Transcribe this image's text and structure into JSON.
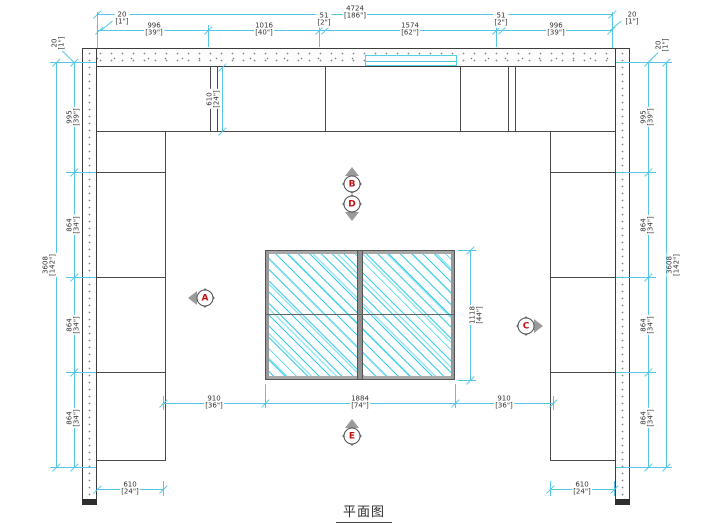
{
  "title": "平面图",
  "colors": {
    "dimension_line": "#55c7e5",
    "hatch": "#2dcde4",
    "drawing_line": "#4a4a4a",
    "marker_letter": "#c11111"
  },
  "dimensions": {
    "top_overall": {
      "mm": "4724",
      "inch": "[186\"]"
    },
    "top_chain": [
      {
        "mm": "20",
        "inch": "[1\"]"
      },
      {
        "mm": "996",
        "inch": "[39\"]"
      },
      {
        "mm": "1016",
        "inch": "[40\"]"
      },
      {
        "mm": "51",
        "inch": "[2\"]"
      },
      {
        "mm": "1574",
        "inch": "[62\"]"
      },
      {
        "mm": "51",
        "inch": "[2\"]"
      },
      {
        "mm": "996",
        "inch": "[39\"]"
      },
      {
        "mm": "20",
        "inch": "[1\"]"
      }
    ],
    "side_overall": {
      "mm": "3608",
      "inch": "[142\"]"
    },
    "side_chain": [
      {
        "mm": "20",
        "inch": "[1\"]"
      },
      {
        "mm": "995",
        "inch": "[39\"]"
      },
      {
        "mm": "864",
        "inch": "[34\"]"
      },
      {
        "mm": "864",
        "inch": "[34\"]"
      },
      {
        "mm": "864",
        "inch": "[34\"]"
      }
    ],
    "cabinet_depth": {
      "mm": "610",
      "inch": "[24\"]"
    },
    "floor_chain": [
      {
        "mm": "910",
        "inch": "[36\"]"
      },
      {
        "mm": "1884",
        "inch": "[74\"]"
      },
      {
        "mm": "910",
        "inch": "[36\"]"
      }
    ],
    "table_depth": {
      "mm": "1118",
      "inch": "[44\"]"
    }
  },
  "markers": {
    "a": "A",
    "b": "B",
    "c": "C",
    "d": "D",
    "e": "E"
  }
}
